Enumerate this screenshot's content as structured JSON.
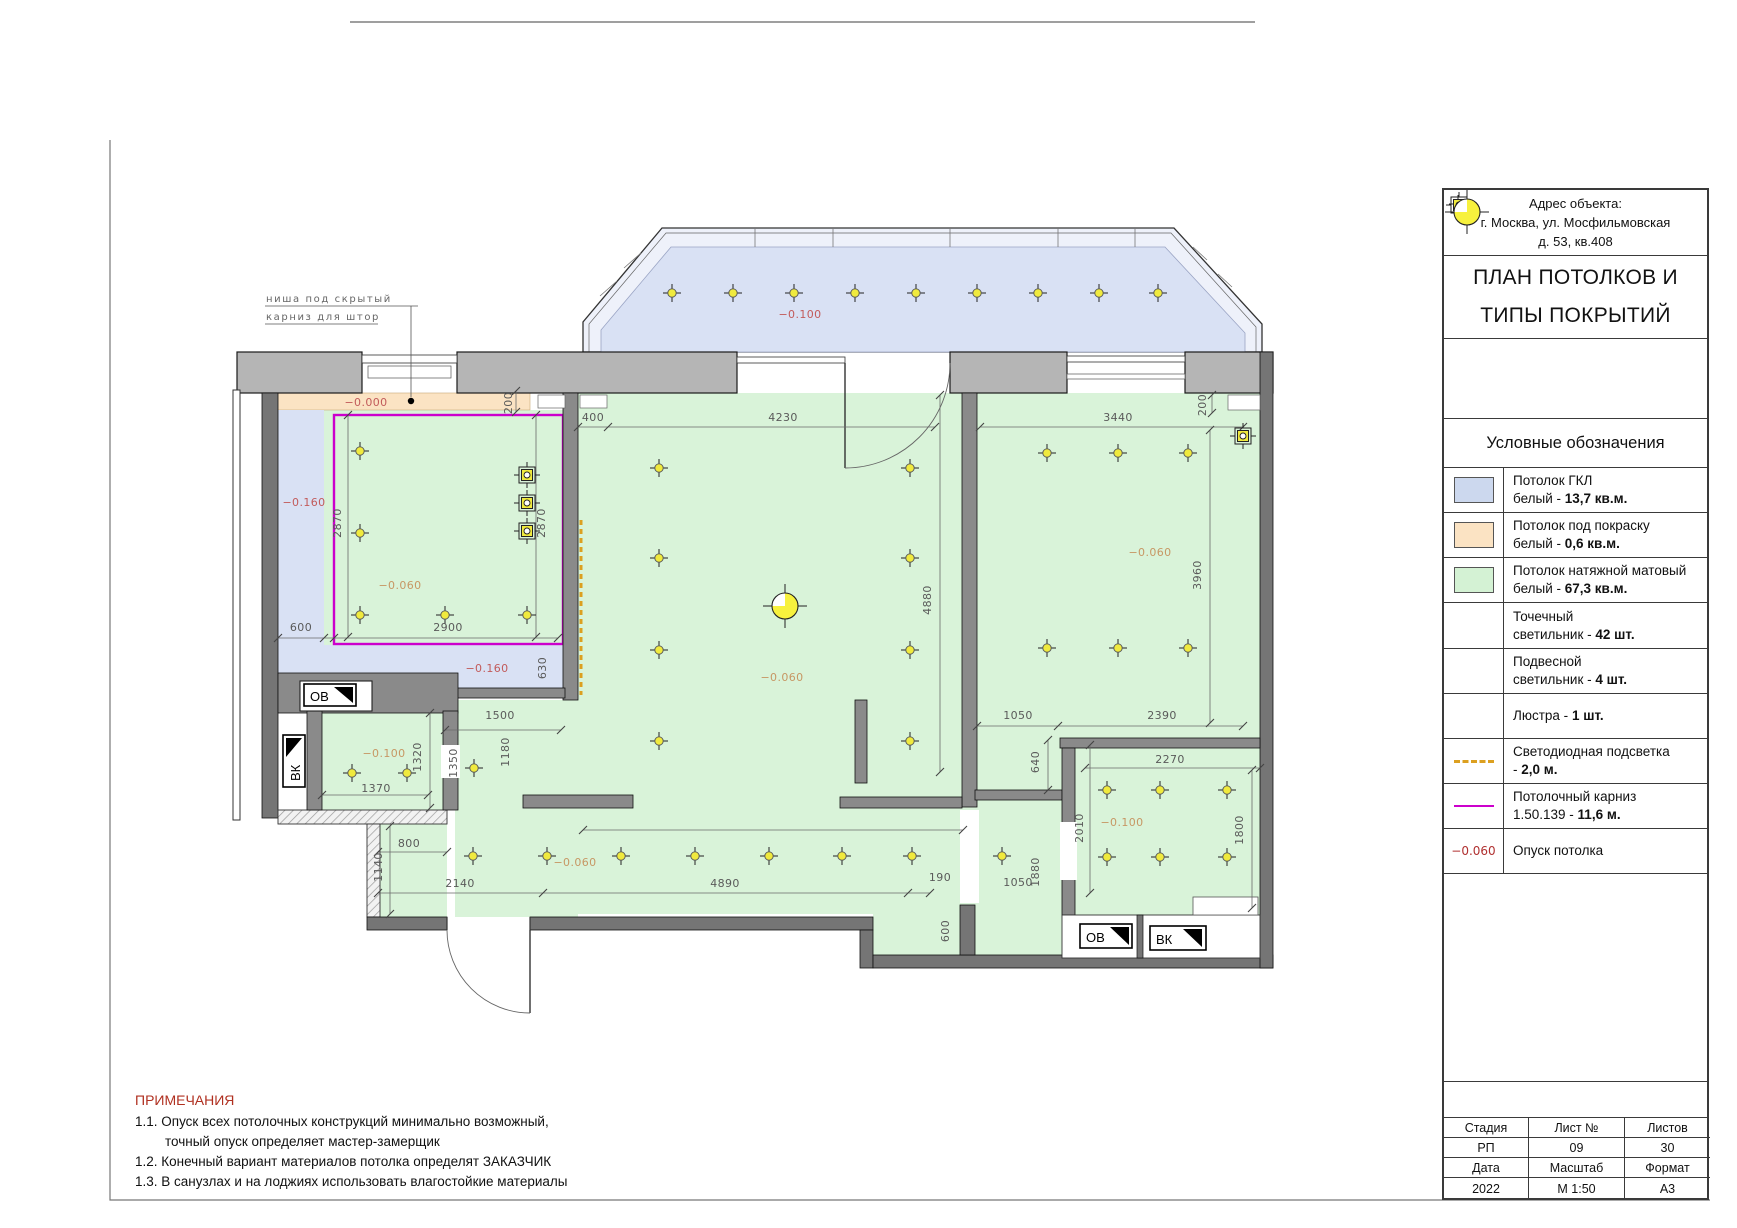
{
  "titleblock": {
    "address": [
      "Адрес объекта:",
      "г. Москва, ул. Мосфильмовская",
      "д. 53, кв.408"
    ],
    "title_lines": [
      "ПЛАН ПОТОЛКОВ И",
      "ТИПЫ ПОКРЫТИЙ"
    ],
    "legend_header": "Условные обозначения",
    "legend": [
      {
        "sym": "swatch",
        "color": "#ccd8ee",
        "line1": "Потолок ГКЛ",
        "line2": "белый - ",
        "bold": "13,7 кв.м."
      },
      {
        "sym": "swatch",
        "color": "#fbe3c3",
        "line1": "Потолок под покраску",
        "line2": "белый - ",
        "bold": "0,6 кв.м."
      },
      {
        "sym": "swatch",
        "color": "#d4f2d4",
        "line1": "Потолок натяжной матовый",
        "line2": "белый - ",
        "bold": "67,3 кв.м."
      },
      {
        "sym": "spot",
        "color": "",
        "line1": "Точечный",
        "line2": "светильник - ",
        "bold": "42 шт."
      },
      {
        "sym": "pendant",
        "color": "",
        "line1": "Подвесной",
        "line2": "светильник - ",
        "bold": "4 шт."
      },
      {
        "sym": "chandelier",
        "color": "",
        "line1": "",
        "line2": "Люстра - ",
        "bold": "1 шт."
      },
      {
        "sym": "led",
        "color": "#dca020",
        "line1": "Светодиодная подсветка",
        "line2": "- ",
        "bold": "2,0 м."
      },
      {
        "sym": "cornice",
        "color": "#cc00cc",
        "line1": "Потолочный карниз",
        "line2": "1.50.139 - ",
        "bold": "11,6 м."
      },
      {
        "sym": "level",
        "color": "#b03030",
        "symtext": "−0.060",
        "line1": "",
        "line2": "Опуск потолка",
        "bold": ""
      }
    ],
    "table": {
      "r1": [
        "Стадия",
        "Лист №",
        "Листов"
      ],
      "r2": [
        "РП",
        "09",
        "30"
      ],
      "r3": [
        "Дата",
        "Масштаб",
        "Формат"
      ],
      "r4": [
        "2022",
        "М 1:50",
        "А3"
      ]
    }
  },
  "notes": {
    "title": "ПРИМЕЧАНИЯ",
    "lines": [
      "1.1. Опуск всех потолочных конструкций минимально возможный,",
      "точный опуск определяет мастер-замерщик",
      "1.2. Конечный вариант материалов потолка определят ЗАКАЗЧИК",
      "1.3. В санузлах и на лоджиях использовать влагостойкие материалы"
    ]
  },
  "plan": {
    "annotation": [
      "ниша под скрытый",
      "карниз для штор"
    ],
    "shafts": [
      "ОВ",
      "ВК",
      "ОВ",
      "ВК"
    ],
    "labels": [
      {
        "t": "−0.100",
        "x": 800,
        "y": 318,
        "c": "lr"
      },
      {
        "t": "−0.000",
        "x": 366,
        "y": 406,
        "c": "lr"
      },
      {
        "t": "−0.160",
        "x": 304,
        "y": 506,
        "c": "lr"
      },
      {
        "t": "−0.160",
        "x": 487,
        "y": 672,
        "c": "lr"
      },
      {
        "t": "−0.060",
        "x": 400,
        "y": 589,
        "c": "lt"
      },
      {
        "t": "−0.060",
        "x": 782,
        "y": 681,
        "c": "lt"
      },
      {
        "t": "−0.060",
        "x": 1150,
        "y": 556,
        "c": "lt"
      },
      {
        "t": "−0.060",
        "x": 575,
        "y": 866,
        "c": "lt"
      },
      {
        "t": "−0.100",
        "x": 384,
        "y": 757,
        "c": "lt"
      },
      {
        "t": "−0.100",
        "x": 1122,
        "y": 826,
        "c": "lt"
      },
      {
        "t": "200",
        "x": 512,
        "y": 403,
        "r": 1,
        "c": "d"
      },
      {
        "t": "200",
        "x": 1206,
        "y": 405,
        "r": 1,
        "c": "d"
      },
      {
        "t": "2870",
        "x": 341,
        "y": 523,
        "r": 1,
        "c": "d"
      },
      {
        "t": "2870",
        "x": 545,
        "y": 523,
        "r": 1,
        "c": "d"
      },
      {
        "t": "600",
        "x": 301,
        "y": 631,
        "c": "d"
      },
      {
        "t": "2900",
        "x": 448,
        "y": 631,
        "c": "d"
      },
      {
        "t": "630",
        "x": 546,
        "y": 668,
        "r": 1,
        "c": "d"
      },
      {
        "t": "400",
        "x": 593,
        "y": 421,
        "c": "d"
      },
      {
        "t": "4230",
        "x": 783,
        "y": 421,
        "c": "d"
      },
      {
        "t": "4880",
        "x": 931,
        "y": 600,
        "r": 1,
        "c": "d"
      },
      {
        "t": "3440",
        "x": 1118,
        "y": 421,
        "c": "d"
      },
      {
        "t": "3960",
        "x": 1201,
        "y": 575,
        "r": 1,
        "c": "d"
      },
      {
        "t": "1050",
        "x": 1018,
        "y": 719,
        "c": "d"
      },
      {
        "t": "2390",
        "x": 1162,
        "y": 719,
        "c": "d"
      },
      {
        "t": "2270",
        "x": 1170,
        "y": 763,
        "c": "d"
      },
      {
        "t": "640",
        "x": 1039,
        "y": 762,
        "r": 1,
        "c": "d"
      },
      {
        "t": "2010",
        "x": 1083,
        "y": 828,
        "r": 1,
        "c": "d"
      },
      {
        "t": "1800",
        "x": 1243,
        "y": 830,
        "r": 1,
        "c": "d"
      },
      {
        "t": "1880",
        "x": 1039,
        "y": 872,
        "r": 1,
        "c": "d"
      },
      {
        "t": "1050",
        "x": 1018,
        "y": 886,
        "c": "d"
      },
      {
        "t": "190",
        "x": 940,
        "y": 881,
        "c": "d"
      },
      {
        "t": "1500",
        "x": 500,
        "y": 719,
        "c": "d"
      },
      {
        "t": "1180",
        "x": 509,
        "y": 752,
        "r": 1,
        "c": "d"
      },
      {
        "t": "1350",
        "x": 457,
        "y": 763,
        "r": 1,
        "c": "d"
      },
      {
        "t": "1320",
        "x": 421,
        "y": 757,
        "r": 1,
        "c": "d"
      },
      {
        "t": "1370",
        "x": 376,
        "y": 792,
        "c": "d"
      },
      {
        "t": "800",
        "x": 409,
        "y": 847,
        "c": "d"
      },
      {
        "t": "1140",
        "x": 382,
        "y": 867,
        "r": 1,
        "c": "d"
      },
      {
        "t": "2140",
        "x": 460,
        "y": 887,
        "c": "d"
      },
      {
        "t": "4890",
        "x": 725,
        "y": 887,
        "c": "d"
      },
      {
        "t": "600",
        "x": 949,
        "y": 931,
        "r": 1,
        "c": "d"
      },
      {
        "t": "ниша под скрытый",
        "x": 266,
        "y": 302,
        "c": "an",
        "a": 1
      },
      {
        "t": "карниз для штор",
        "x": 266,
        "y": 320,
        "c": "an",
        "a": 1
      }
    ],
    "lights": {
      "spots": [
        [
          672,
          293
        ],
        [
          733,
          293
        ],
        [
          794,
          293
        ],
        [
          855,
          293
        ],
        [
          916,
          293
        ],
        [
          977,
          293
        ],
        [
          1038,
          293
        ],
        [
          1099,
          293
        ],
        [
          1158,
          293
        ],
        [
          360,
          451
        ],
        [
          360,
          533
        ],
        [
          360,
          615
        ],
        [
          445,
          615
        ],
        [
          527,
          615
        ],
        [
          659,
          468
        ],
        [
          910,
          468
        ],
        [
          659,
          558
        ],
        [
          910,
          558
        ],
        [
          659,
          650
        ],
        [
          910,
          650
        ],
        [
          659,
          741
        ],
        [
          910,
          741
        ],
        [
          1047,
          453
        ],
        [
          1118,
          453
        ],
        [
          1188,
          453
        ],
        [
          1047,
          648
        ],
        [
          1118,
          648
        ],
        [
          1188,
          648
        ],
        [
          352,
          773
        ],
        [
          407,
          773
        ],
        [
          474,
          768
        ],
        [
          473,
          856
        ],
        [
          547,
          856
        ],
        [
          621,
          856
        ],
        [
          695,
          856
        ],
        [
          769,
          856
        ],
        [
          842,
          856
        ],
        [
          912,
          856
        ],
        [
          1002,
          856
        ],
        [
          1107,
          790
        ],
        [
          1160,
          790
        ],
        [
          1227,
          790
        ],
        [
          1107,
          857
        ],
        [
          1160,
          857
        ],
        [
          1227,
          857
        ]
      ],
      "pendants": [
        [
          527,
          475
        ],
        [
          527,
          503
        ],
        [
          527,
          531
        ],
        [
          1243,
          436
        ]
      ],
      "chandelier": [
        [
          785,
          606
        ]
      ]
    },
    "levels_note": {
      "gkl": "−0.160 / −0.100",
      "stretch": "−0.060",
      "paint": "−0.000"
    }
  },
  "colors": {
    "ceiling_gkl": "#d9e1f4",
    "ceiling_paint": "#fbe3c3",
    "ceiling_stretch": "#d9f3d9",
    "cornice": "#cc00cc",
    "led": "#dca020",
    "spot_yellow": "#f0ea3e",
    "level_red": "#c25b5b",
    "level_tan": "#c79764",
    "wall_light": "#b5b5b5",
    "wall_dark": "#757575"
  }
}
